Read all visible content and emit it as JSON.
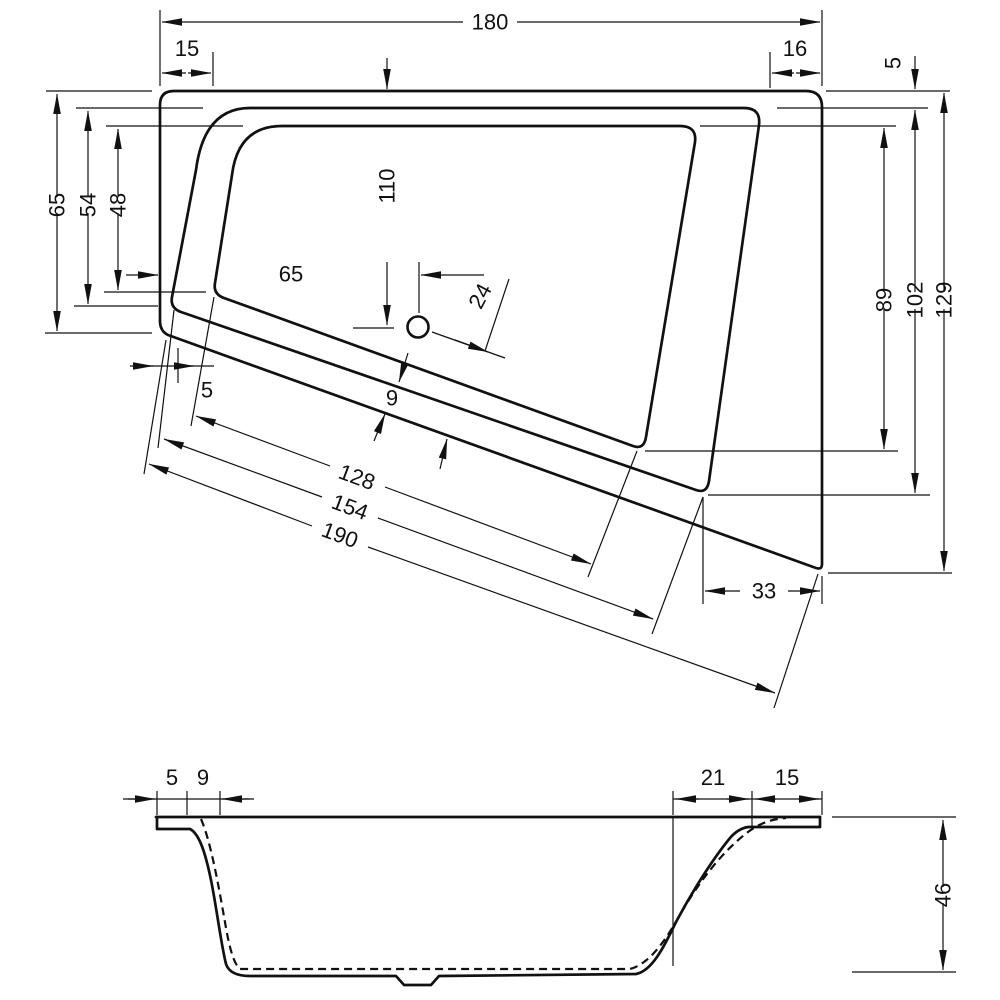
{
  "plan": {
    "name": "bathtub plan view",
    "dims": {
      "total_width": "180",
      "left_rim": "15",
      "right_rim": "16",
      "edge_right": "5",
      "left_outer": "65",
      "left_mid": "54",
      "left_inner": "48",
      "drain_vertical": "110",
      "drain_horizontal": "65",
      "drain_diagonal": "24",
      "right_inner": "89",
      "right_mid": "102",
      "right_outer": "129",
      "corner_gap": "5",
      "band_width": "9",
      "bottom_inner": "128",
      "bottom_mid": "154",
      "bottom_outer": "190",
      "corner_offset": "33"
    }
  },
  "section": {
    "name": "bathtub section view",
    "dims": {
      "rim_left": "5",
      "wall_left": "9",
      "slope_right": "21",
      "rim_right": "15",
      "depth": "46"
    }
  }
}
